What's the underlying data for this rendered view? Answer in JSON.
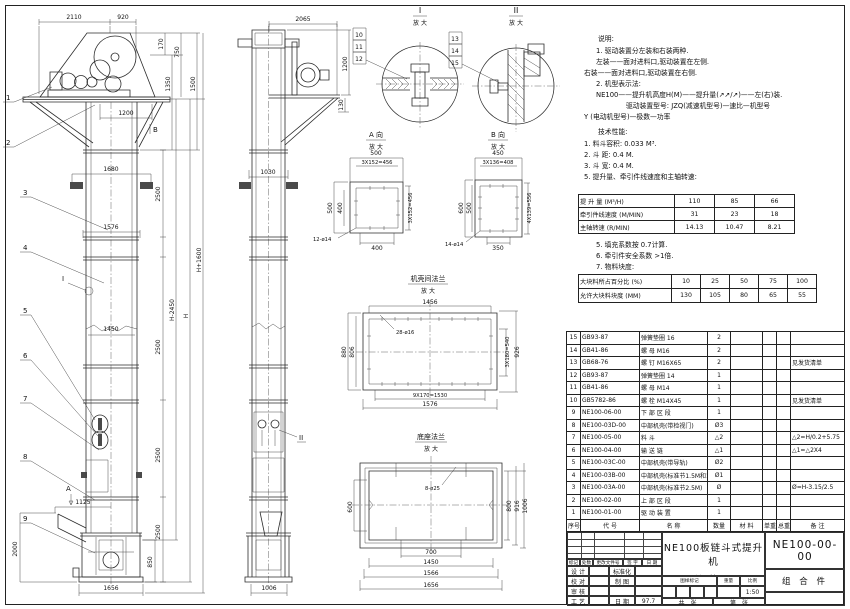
{
  "notes": {
    "h": "说明:",
    "l": [
      "1. 驱动装置分左装和右装两种.",
      "左装——面对进料口,驱动装置在左侧.",
      "右装——面对进料口,驱动装置在右侧.",
      "2. 机型表示法:",
      "NE100——提升机高度H(M)——提升量(↗↗/↗)——左(右)装.",
      "驱动装置型号: JZQ(减速机型号)—速比—机型号",
      "Y (电动机型号)—极数—功率"
    ],
    "th": "技术性能:",
    "t1": [
      "1. 料斗容积: 0.033 M³.",
      "2. 斗  距: 0.4 M.",
      "3. 斗  宽: 0.4 M.",
      "5. 提升量、牵引件线速度和主轴转速:"
    ],
    "t2": [
      "5. 填充系数按 0.7计算.",
      "6. 牵引件安全系数 >1倍.",
      "7. 物料块度:"
    ]
  },
  "perf": {
    "rows": [
      {
        "label": "提 升 量  (M³/H)",
        "v1": "110",
        "v2": "85",
        "v3": "66"
      },
      {
        "label": "牵引件线速度 (M/MIN)",
        "v1": "31",
        "v2": "23",
        "v3": "18"
      },
      {
        "label": "主轴转速  (R/MIN)",
        "v1": "14.13",
        "v2": "10.47",
        "v3": "8.21"
      }
    ]
  },
  "lump": {
    "rows": [
      {
        "label": "大块料所占百分比 (%)",
        "v1": "10",
        "v2": "25",
        "v3": "50",
        "v4": "75",
        "v5": "100"
      },
      {
        "label": "允许大块料块度 (MM)",
        "v1": "130",
        "v2": "105",
        "v3": "80",
        "v4": "65",
        "v5": "55"
      }
    ]
  },
  "bom": {
    "h": {
      "no": "序号",
      "code": "代  号",
      "name": "名  称",
      "qty": "数量",
      "mat": "材  料",
      "uw": "单重",
      "tw": "总重",
      "rem": "备  注"
    },
    "rows": [
      {
        "no": "15",
        "code": "GB93-87",
        "name": "弹簧垫圈 16",
        "qty": "2",
        "mat": "",
        "uw": "",
        "tw": "",
        "rem": ""
      },
      {
        "no": "14",
        "code": "GB41-86",
        "name": "螺  母  M16",
        "qty": "2",
        "mat": "",
        "uw": "",
        "tw": "",
        "rem": ""
      },
      {
        "no": "13",
        "code": "GB68-76",
        "name": "螺  钉  M16X65",
        "qty": "2",
        "mat": "",
        "uw": "",
        "tw": "",
        "rem": "见发货清单"
      },
      {
        "no": "12",
        "code": "GB93-87",
        "name": "弹簧垫圈 14",
        "qty": "1",
        "mat": "",
        "uw": "",
        "tw": "",
        "rem": ""
      },
      {
        "no": "11",
        "code": "GB41-86",
        "name": "螺  母  M14",
        "qty": "1",
        "mat": "",
        "uw": "",
        "tw": "",
        "rem": ""
      },
      {
        "no": "10",
        "code": "GB5782-86",
        "name": "螺  栓  M14X45",
        "qty": "1",
        "mat": "",
        "uw": "",
        "tw": "",
        "rem": "见发货清单"
      },
      {
        "no": "9",
        "code": "NE100-06-00",
        "name": "下 部 区 段",
        "qty": "1",
        "mat": "",
        "uw": "",
        "tw": "",
        "rem": ""
      },
      {
        "no": "8",
        "code": "NE100-03D-00",
        "name": "中部机壳(带检视门)",
        "qty": "Ø3",
        "mat": "",
        "uw": "",
        "tw": "",
        "rem": ""
      },
      {
        "no": "7",
        "code": "NE100-05-00",
        "name": "料  斗",
        "qty": "△2",
        "mat": "",
        "uw": "",
        "tw": "",
        "rem": "△2=H/0.2+5.75"
      },
      {
        "no": "6",
        "code": "NE100-04-00",
        "name": "输 送 链",
        "qty": "△1",
        "mat": "",
        "uw": "",
        "tw": "",
        "rem": "△1=△2X4"
      },
      {
        "no": "5",
        "code": "NE100-03C-00",
        "name": "中部机壳(带导轨)",
        "qty": "Ø2",
        "mat": "",
        "uw": "",
        "tw": "",
        "rem": ""
      },
      {
        "no": "4",
        "code": "NE100-03B-00",
        "name": "中部机壳(标准节1.5M和1M)",
        "qty": "Ø1",
        "mat": "",
        "uw": "",
        "tw": "",
        "rem": ""
      },
      {
        "no": "3",
        "code": "NE100-03A-00",
        "name": "中部机壳(标准节2.5M)",
        "qty": "Ø",
        "mat": "",
        "uw": "",
        "tw": "",
        "rem": "Ø=H-3.15/2.5"
      },
      {
        "no": "2",
        "code": "NE100-02-00",
        "name": "上 部 区 段",
        "qty": "1",
        "mat": "",
        "uw": "",
        "tw": "",
        "rem": ""
      },
      {
        "no": "1",
        "code": "NE100-01-00",
        "name": "驱 动 装 置",
        "qty": "1",
        "mat": "",
        "uw": "",
        "tw": "",
        "rem": ""
      }
    ]
  },
  "tb": {
    "rev": [
      "标记",
      "处数",
      "更改文件号",
      "签 字",
      "日 期"
    ],
    "r1a": "设 计",
    "r1b": "标准化",
    "r2a": "校 对",
    "r2b": "制 图",
    "r3a": "审 核",
    "r3b": "",
    "r4a": "工 艺",
    "r4b": "日 期",
    "date": "97.7",
    "t1": "NE100板链斗式提升机",
    "t2": "总  装  图",
    "m1": "图样标记",
    "m2": "重量",
    "m3": "比例",
    "scale": "1:50",
    "s1": "共　张",
    "s2": "第　张",
    "code": "NE100-00-00",
    "type": "组 合 件"
  },
  "v": {
    "f": {
      "d": [
        "2110",
        "920",
        "170",
        "750",
        "1350",
        "1500",
        "1200",
        "1680",
        "2500",
        "1576",
        "H+1600",
        "H-2450",
        "H",
        "1450",
        "2500",
        "2500",
        "2500",
        "1125",
        "2000",
        "850",
        "1656"
      ],
      "b": [
        "1",
        "2",
        "3",
        "4",
        "5",
        "6",
        "7",
        "8",
        "9"
      ],
      "la": "A",
      "lb": "B",
      "li": "I"
    },
    "s": {
      "d": [
        "2065",
        "1200",
        "130",
        "1030",
        "1006"
      ],
      "lii": "II"
    },
    "d1": {
      "t": "I",
      "z": "放 大",
      "b": [
        "10",
        "11",
        "12"
      ]
    },
    "d2": {
      "t": "II",
      "z": "放 大",
      "b": [
        "13",
        "14",
        "15"
      ]
    },
    "va": {
      "t": "A 向",
      "z": "放 大",
      "d": [
        "500",
        "3X152=456",
        "500",
        "400",
        "3X152=456",
        "400",
        "12-ø14"
      ]
    },
    "vb": {
      "t": "B 向",
      "z": "放 大",
      "d": [
        "450",
        "3X136=408",
        "600",
        "500",
        "4X139=556",
        "350",
        "14-ø14"
      ]
    },
    "fd": {
      "t": "机壳间法兰",
      "z": "放 大",
      "d": [
        "1456",
        "28-ø16",
        "880",
        "806",
        "3X180=540",
        "926",
        "9X170=1530",
        "1576"
      ]
    },
    "bd": {
      "t": "底座法兰",
      "z": "放 大",
      "d": [
        "8-ø25",
        "600",
        "800",
        "916",
        "1006",
        "700",
        "1450",
        "1566",
        "1656"
      ]
    }
  }
}
